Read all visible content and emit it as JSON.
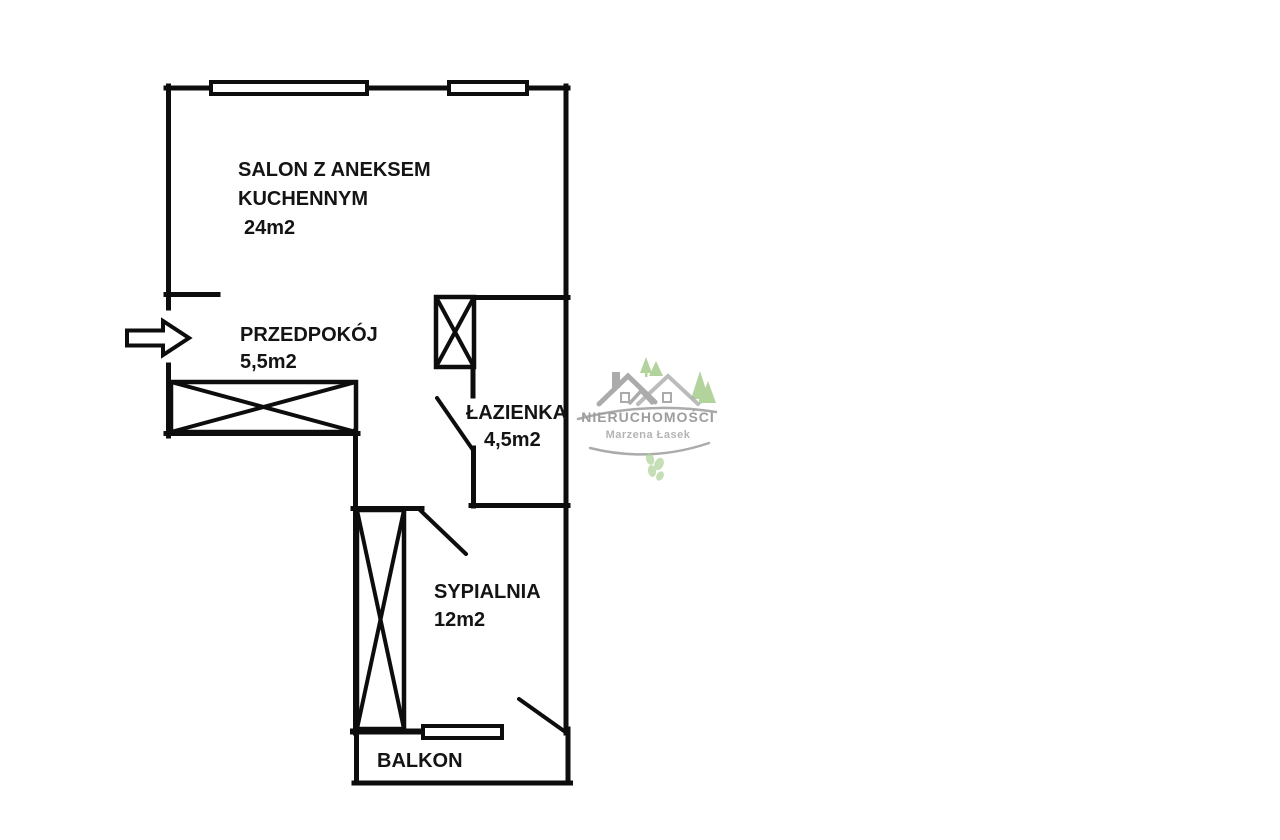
{
  "plan": {
    "line_color": "#0d0d0d",
    "paper_color": "#ffffff"
  },
  "rooms": {
    "salon": {
      "name_line1": "SALON Z ANEKSEM",
      "name_line2": "KUCHENNYM",
      "area": "24m2"
    },
    "przedpokoj": {
      "name": "PRZEDPOKÓJ",
      "area": "5,5m2"
    },
    "lazienka": {
      "name": "ŁAZIENKA",
      "area": "4,5m2"
    },
    "sypialnia": {
      "name": "SYPIALNIA",
      "area": "12m2"
    },
    "balkon": {
      "name": "BALKON"
    }
  },
  "watermark": {
    "brand": "NIERUCHOMOŚCI",
    "owner": "Marzena Łasek",
    "gray": "#9d9d9d",
    "light_gray": "#b4b4b4",
    "green": "#a6cc8d"
  }
}
